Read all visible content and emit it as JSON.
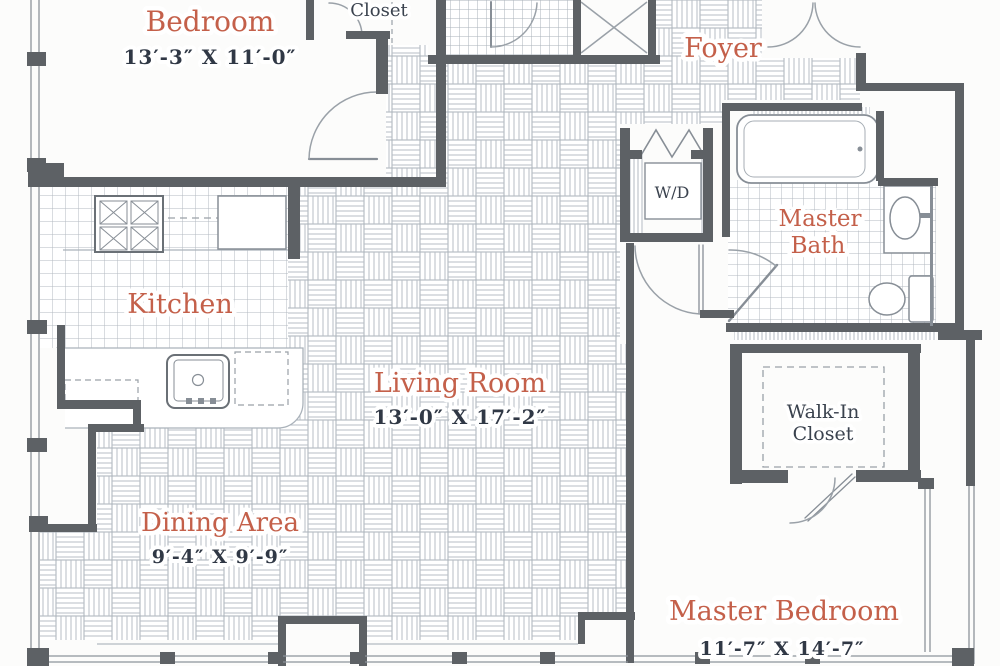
{
  "plan": {
    "type": "apartment-floor-plan",
    "rooms": {
      "bedroom": {
        "label": "Bedroom",
        "dims": "13′-3″ X 11′-0″"
      },
      "closet": {
        "label": "Closet"
      },
      "foyer": {
        "label": "Foyer"
      },
      "laundry": {
        "label": "W/D"
      },
      "master_bath": {
        "label_line1": "Master",
        "label_line2": "Bath"
      },
      "kitchen": {
        "label": "Kitchen"
      },
      "living_room": {
        "label": "Living Room",
        "dims": "13′-0″ X 17′-2″"
      },
      "dining_area": {
        "label": "Dining Area",
        "dims": "9′-4″ X 9′-9″"
      },
      "walk_in_closet": {
        "label_line1": "Walk-In",
        "label_line2": "Closet"
      },
      "master_bedroom": {
        "label": "Master Bedroom",
        "dims": "11′-7″ X 14′-7″"
      }
    },
    "colors": {
      "room_label": "#c4604a",
      "dimension_text": "#303845",
      "secondary_label": "#3a424e",
      "wall": "#5d6165",
      "floor_pattern_line": "#b3bac1",
      "fixture_line": "#878e96",
      "background": "#fcfcfb"
    }
  }
}
